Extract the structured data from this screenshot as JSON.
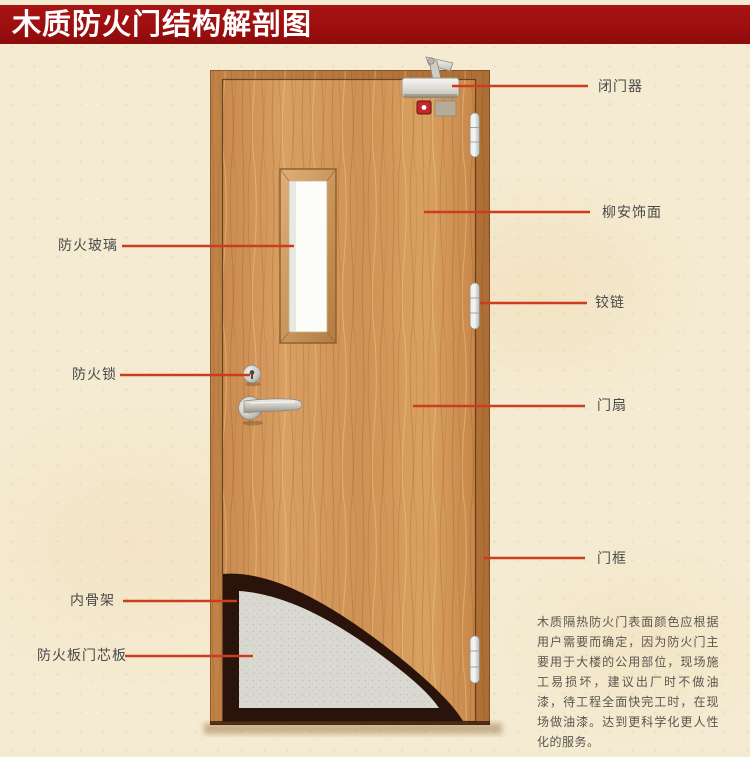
{
  "title": "木质防火门结构解剖图",
  "labels": {
    "fire_glass": "防火玻璃",
    "fire_lock": "防火锁",
    "inner_frame": "内骨架",
    "fire_board_core": "防火板门芯板",
    "door_closer": "闭门器",
    "lauan_veneer": "柳安饰面",
    "hinge": "铰链",
    "door_leaf": "门扇",
    "door_frame": "门框"
  },
  "description": "木质隔热防火门表面颜色应根据用户需要而确定，因为防火门主要用于大楼的公用部位，现场施工易损坏，建议出厂时不做油漆，待工程全面快完工时，在现场做油漆。达到更科学化更人性化的服务。",
  "colors": {
    "banner_red": "#9e0f0f",
    "accent_line": "#cc3d20",
    "label_text": "#4a4a4a",
    "paper": "#f4ebd2",
    "desc_text": "#5a5650"
  }
}
